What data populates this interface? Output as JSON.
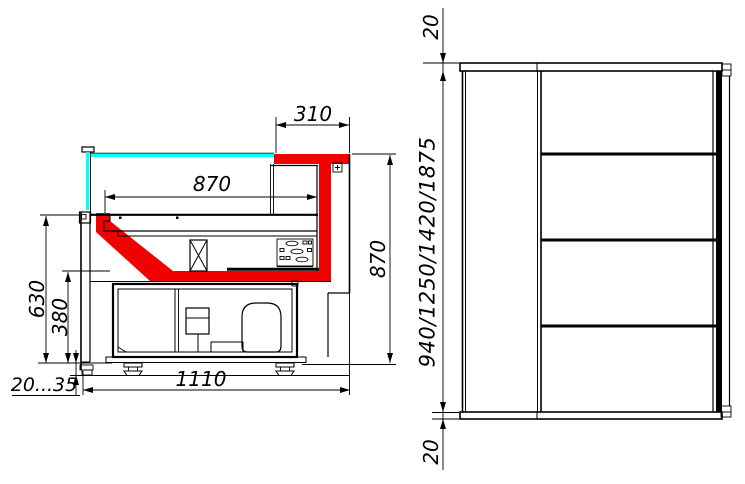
{
  "drawing": {
    "kind": "technical-drawing",
    "subject": "refrigerated-display-case",
    "colors": {
      "profile_red": "#f10000",
      "glass_cyan": "#00ffff",
      "line_black": "#000000",
      "background": "#ffffff"
    },
    "section_view": {
      "name": "cross-section-view",
      "dims": {
        "canopy_depth": "310",
        "deck_depth": "870",
        "section_height": "870",
        "front_height": "630",
        "base_height": "380",
        "foot_range": "20...35",
        "overall_depth": "1110"
      }
    },
    "side_view": {
      "name": "side-elevation-view",
      "dims": {
        "top_panel": "20",
        "height_options": "940/1250/1420/1875",
        "bottom_panel": "20"
      }
    }
  }
}
